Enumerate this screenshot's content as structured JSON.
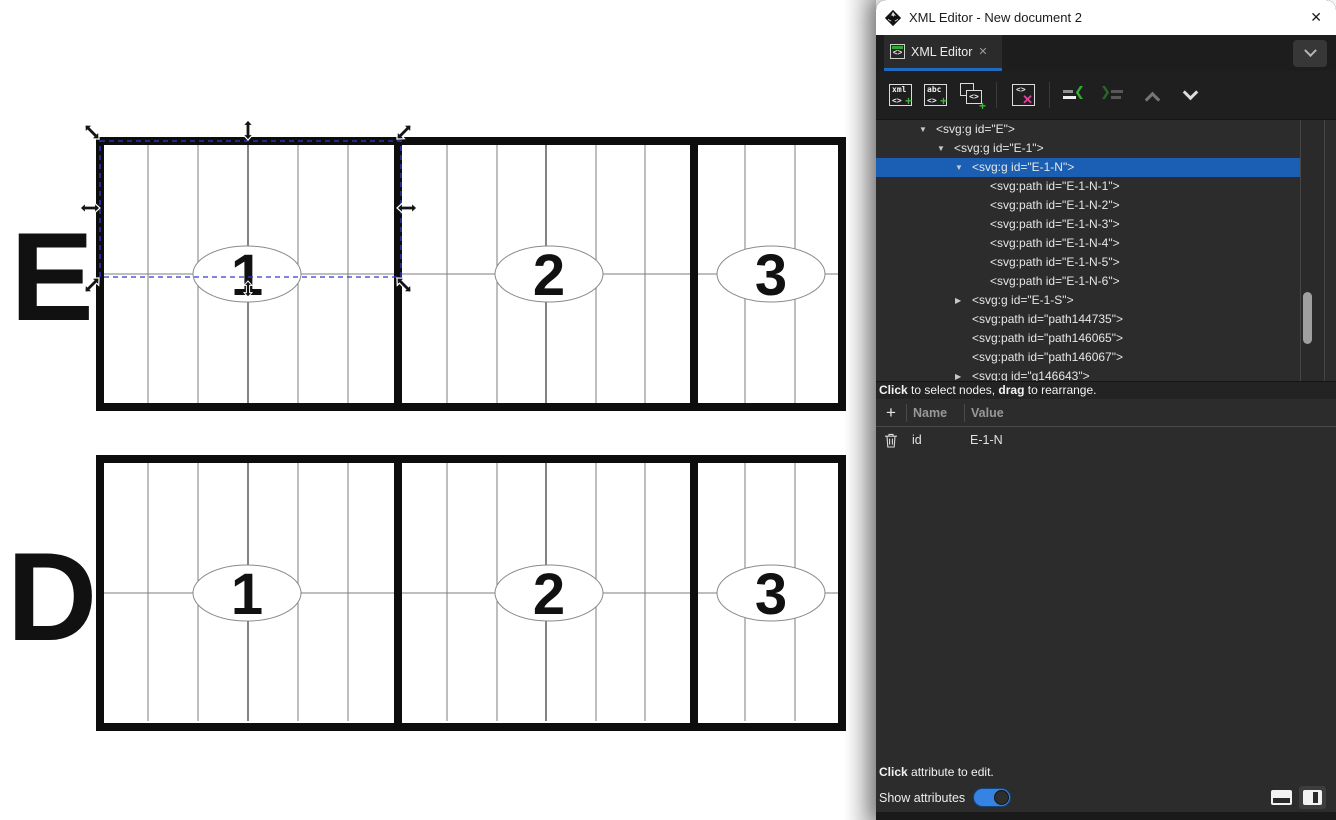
{
  "window": {
    "title": "XML Editor - New document 2",
    "close_glyph": "✕"
  },
  "tab": {
    "label": "XML Editor",
    "close_glyph": "✕",
    "icon_tag": "<>"
  },
  "toolbar": {
    "glyphs": {
      "xml": "xml",
      "abc": "abc",
      "tag": "<>",
      "plus": "+",
      "x": "✕",
      "angle_left": "❮",
      "angle_right": "❯"
    }
  },
  "tree": {
    "expander_glyphs": {
      "open": "▼",
      "closed": "▶"
    },
    "nodes": [
      {
        "depth": 0,
        "state": "open",
        "label": "<svg:g id=\"E\">"
      },
      {
        "depth": 1,
        "state": "open",
        "label": "<svg:g id=\"E-1\">"
      },
      {
        "depth": 2,
        "state": "open",
        "label": "<svg:g id=\"E-1-N\">",
        "selected": true
      },
      {
        "depth": 3,
        "state": null,
        "label": "<svg:path id=\"E-1-N-1\">"
      },
      {
        "depth": 3,
        "state": null,
        "label": "<svg:path id=\"E-1-N-2\">"
      },
      {
        "depth": 3,
        "state": null,
        "label": "<svg:path id=\"E-1-N-3\">"
      },
      {
        "depth": 3,
        "state": null,
        "label": "<svg:path id=\"E-1-N-4\">"
      },
      {
        "depth": 3,
        "state": null,
        "label": "<svg:path id=\"E-1-N-5\">"
      },
      {
        "depth": 3,
        "state": null,
        "label": "<svg:path id=\"E-1-N-6\">"
      },
      {
        "depth": 2,
        "state": "closed",
        "label": "<svg:g id=\"E-1-S\">"
      },
      {
        "depth": 2,
        "state": null,
        "label": "<svg:path id=\"path144735\">"
      },
      {
        "depth": 2,
        "state": null,
        "label": "<svg:path id=\"path146065\">"
      },
      {
        "depth": 2,
        "state": null,
        "label": "<svg:path id=\"path146067\">"
      },
      {
        "depth": 2,
        "state": "closed",
        "label": "<svg:g id=\"g146643\">"
      }
    ],
    "status": {
      "bold1": "Click",
      "text1": " to select nodes, ",
      "bold2": "drag",
      "text2": " to rearrange."
    }
  },
  "attributes": {
    "add_glyph": "+",
    "header": {
      "name": "Name",
      "value": "Value"
    },
    "rows": [
      {
        "name": "id",
        "value": "E-1-N"
      }
    ],
    "hint": {
      "bold": "Click",
      "rest": " attribute to edit."
    },
    "show_label": "Show attributes",
    "show_on": true
  },
  "canvas": {
    "rows": [
      {
        "letter": "E",
        "labels": [
          "1",
          "2",
          "3"
        ]
      },
      {
        "letter": "D",
        "labels": [
          "1",
          "2",
          "3"
        ]
      }
    ]
  },
  "colors": {
    "tree_selection": "#1a5fb4",
    "tab_underline": "#1d6ac0",
    "toggle_on": "#3584e4",
    "accent_green": "#3cb83c",
    "delete_pink": "#ea3d9e",
    "selection_dash": "#3838d2"
  }
}
